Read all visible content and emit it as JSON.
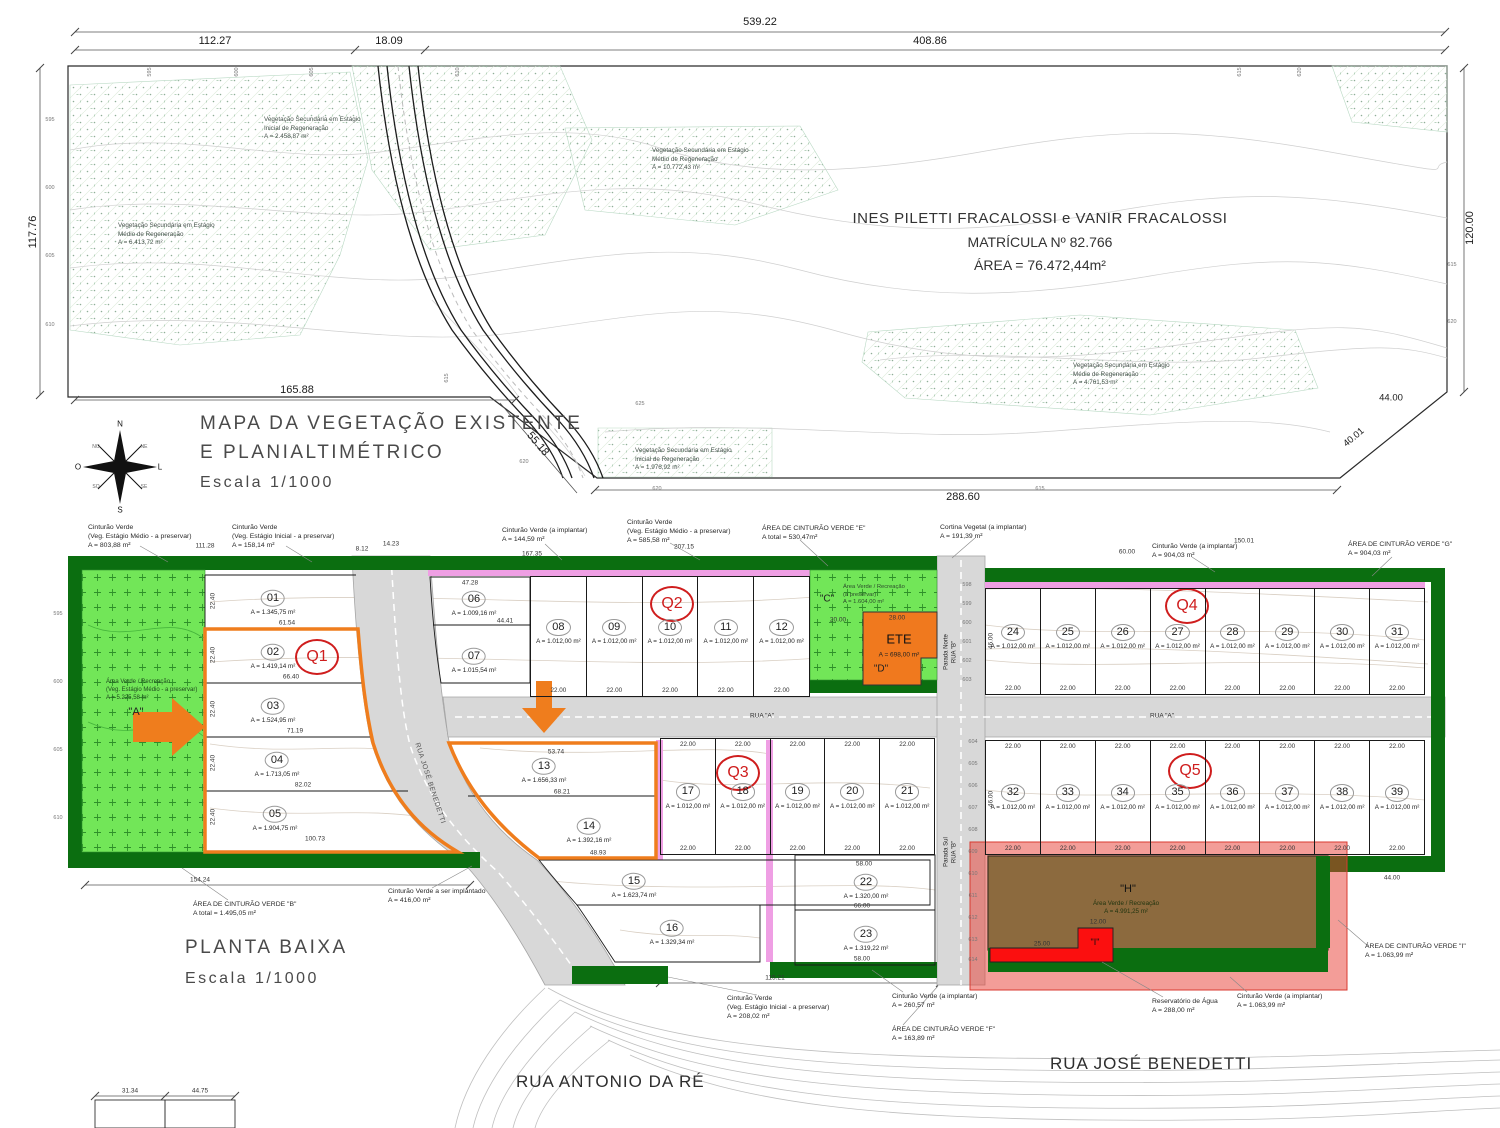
{
  "top_map": {
    "owner": {
      "line1": "INES PILETTI FRACALOSSI e VANIR FRACALOSSI",
      "line2": "MATRÍCULA Nº 82.766",
      "line3": "ÁREA = 76.472,44m²"
    },
    "title": {
      "line1": "MAPA DA VEGETAÇÃO EXISTENTE",
      "line2": "E PLANIALTIMÉTRICO",
      "scale": "Escala 1/1000"
    },
    "compass": {
      "n": "N",
      "s": "S",
      "l": "L",
      "o": "O",
      "no": "NO",
      "ne": "NE",
      "so": "SO",
      "se": "SE"
    },
    "dims": {
      "total": "539.22",
      "seg1": "112.27",
      "seg2": "18.09",
      "seg3": "408.86",
      "left": "117.76",
      "right": "120.00",
      "bottom_left": "165.88",
      "road_diag": "55.18",
      "bottom_mid": "288.60",
      "right_a": "44.00",
      "right_b": "40.01"
    },
    "veg": [
      {
        "l1": "Vegetação Secundária em Estágio",
        "l2": "Inicial de Regeneração",
        "l3": "A = 2.458,87 m²"
      },
      {
        "l1": "Vegetação Secundária em Estágio",
        "l2": "Médio de Regeneração",
        "l3": "A = 6.413,72 m²"
      },
      {
        "l1": "Vegetação Secundária em Estágio",
        "l2": "Médio de Regeneração",
        "l3": "A = 10.772,43 m²"
      },
      {
        "l1": "Vegetação Secundária em Estágio",
        "l2": "Médio de Regeneração",
        "l3": "A = 4.761,53 m²"
      },
      {
        "l1": "Vegetação Secundária em Estágio",
        "l2": "Inicial de Regeneração",
        "l3": "A = 1.976,92 m²"
      }
    ],
    "elev_top": [
      "595",
      "600",
      "605",
      "610",
      "615",
      "620"
    ],
    "elev_left": [
      "595",
      "600",
      "605",
      "610"
    ],
    "elev_right": [
      "615",
      "620"
    ],
    "elev_inner": [
      "615",
      "625",
      "620",
      "620",
      "615"
    ]
  },
  "plan": {
    "title": "PLANTA BAIXA",
    "scale": "Escala 1/1000",
    "streets": {
      "antonio": "RUA ANTONIO DA RÉ",
      "benedetti": "RUA JOSÉ BENEDETTI",
      "benedetti_diag": "RUA JOSÉ BENEDETTI",
      "rua_a": "RUA \"A\"",
      "parada_norte_l1": "Parada Norte",
      "parada_norte_l2": "RUA \"B\"",
      "parada_sul_l1": "Parada Sul",
      "parada_sul_l2": "RUA \"B\""
    },
    "quadras": {
      "q1": "Q1",
      "q2": "Q2",
      "q3": "Q3",
      "q4": "Q4",
      "q5": "Q5"
    },
    "std_area": "A = 1.012,00 m²",
    "dims": {
      "lot_w": "22.00",
      "lot_d": "46.00",
      "side": "22.40",
      "w111": "111.28",
      "w167": "167.35",
      "w207": "207.15",
      "w150": "150.01",
      "w154": "154.24",
      "w115": "115.21",
      "w44": "44.00",
      "w8": "8.12",
      "w14": "14.23",
      "w60": "60.00",
      "w20": "20.00",
      "w28": "28.00",
      "w25": "25.00",
      "w12": "12.00",
      "w31": "31.34",
      "w4475": "44.75"
    },
    "q1_lots": [
      {
        "num": "01",
        "area": "A = 1.345,75 m²",
        "len": "61.54"
      },
      {
        "num": "02",
        "area": "A = 1.419,14 m²",
        "len": "66.40"
      },
      {
        "num": "03",
        "area": "A = 1.524,95 m²",
        "len": "71.19"
      },
      {
        "num": "04",
        "area": "A = 1.713,05 m²",
        "len": "82.02"
      },
      {
        "num": "05",
        "area": "A = 1.904,75 m²",
        "len": "100.73"
      }
    ],
    "lot06": {
      "num": "06",
      "area": "A = 1.009,16 m²",
      "top": "47.28",
      "bottom": "44.41"
    },
    "lot07": {
      "num": "07",
      "area": "A = 1.015,54 m²"
    },
    "row_q2": [
      {
        "num": "08"
      },
      {
        "num": "09"
      },
      {
        "num": "10"
      },
      {
        "num": "11"
      },
      {
        "num": "12"
      }
    ],
    "row_q3": [
      {
        "num": "17"
      },
      {
        "num": "18"
      },
      {
        "num": "19"
      },
      {
        "num": "20"
      },
      {
        "num": "21"
      }
    ],
    "row_q4": [
      {
        "num": "24"
      },
      {
        "num": "25"
      },
      {
        "num": "26"
      },
      {
        "num": "27"
      },
      {
        "num": "28"
      },
      {
        "num": "29"
      },
      {
        "num": "30"
      },
      {
        "num": "31"
      }
    ],
    "row_q5": [
      {
        "num": "32"
      },
      {
        "num": "33"
      },
      {
        "num": "34"
      },
      {
        "num": "35"
      },
      {
        "num": "36"
      },
      {
        "num": "37"
      },
      {
        "num": "38"
      },
      {
        "num": "39"
      }
    ],
    "lot13": {
      "num": "13",
      "area": "A = 1.656,33 m²",
      "top": "53.74",
      "bottom": "68.21"
    },
    "lot14": {
      "num": "14",
      "area": "A = 1.392,16 m²",
      "bottom": "48.93"
    },
    "lot15": {
      "num": "15",
      "area": "A = 1.623,74 m²"
    },
    "lot16": {
      "num": "16",
      "area": "A = 1.329,34 m²"
    },
    "lot22": {
      "num": "22",
      "area": "A = 1.320,00 m²",
      "top": "58.00",
      "bottom": "66.00"
    },
    "lot23": {
      "num": "23",
      "area": "A = 1.319,22 m²",
      "bottom": "58.00"
    },
    "green_a": {
      "name": "\"A\"",
      "l1": "Área Verde / Recreação",
      "l2": "(Veg. Estágio Médio - a preservar)",
      "l3": "A = 5.225,58 m²"
    },
    "green_c": {
      "name": "\"C\"",
      "l1": "Área Verde / Recreação",
      "l2": "(a preservar)",
      "l3": "A = 1.604,00 m²"
    },
    "ete": {
      "label": "ETE",
      "area": "A = 698,00 m²",
      "name": "\"D\""
    },
    "area_h": {
      "name": "\"H\"",
      "l1": "Área Verde / Recreação",
      "l2": "A = 4.991,25 m²"
    },
    "area_i": {
      "name": "\"I\""
    },
    "elev_left": [
      "595",
      "600",
      "605",
      "610"
    ],
    "elev_road_n": [
      "598",
      "599",
      "600",
      "601",
      "602",
      "603"
    ],
    "elev_road_s": [
      "604",
      "605",
      "606",
      "607",
      "608",
      "609",
      "610",
      "611",
      "612",
      "613",
      "614"
    ],
    "ann": [
      {
        "l1": "Cinturão Verde",
        "l2": "(Veg. Estágio Médio - a preservar)",
        "l3": "A = 803,88 m²"
      },
      {
        "l1": "Cinturão Verde",
        "l2": "(Veg. Estágio Inicial - a preservar)",
        "l3": "A = 158,14 m²"
      },
      {
        "l1": "Cinturão Verde (a implantar)",
        "l2": "A = 144,59 m²"
      },
      {
        "l1": "Cinturão Verde",
        "l2": "(Veg. Estágio Médio - a preservar)",
        "l3": "A = 585,58 m²"
      },
      {
        "l1": "ÁREA DE CINTURÃO VERDE \"E\"",
        "l2": "A total = 530,47m²"
      },
      {
        "l1": "Cortina Vegetal (a implantar)",
        "l2": "A = 191,39 m²"
      },
      {
        "l1": "Cinturão Verde (a implantar)",
        "l2": "A = 904,03 m²"
      },
      {
        "l1": "ÁREA DE CINTURÃO VERDE \"G\"",
        "l2": "A = 904,03 m²"
      },
      {
        "l1": "ÁREA DE CINTURÃO VERDE \"B\"",
        "l2": "A total = 1.495,05 m²"
      },
      {
        "l1": "Cinturão Verde a ser implantado",
        "l2": "A = 416,00 m²"
      },
      {
        "l1": "Cinturão Verde",
        "l2": "(Veg. Estágio Inicial - a preservar)",
        "l3": "A = 208,02 m²"
      },
      {
        "l1": "Cinturão Verde (a implantar)",
        "l2": "A = 260,57 m²"
      },
      {
        "l1": "ÁREA DE CINTURÃO VERDE \"F\"",
        "l2": "A = 163,89 m²"
      },
      {
        "l1": "Reservatório de Água",
        "l2": "A = 288,00 m²"
      },
      {
        "l1": "Cinturão Verde (a implantar)",
        "l2": "A = 1.063,99 m²"
      },
      {
        "l1": "ÁREA DE CINTURÃO VERDE \"I\"",
        "l2": "A = 1.063,99 m²"
      }
    ]
  }
}
